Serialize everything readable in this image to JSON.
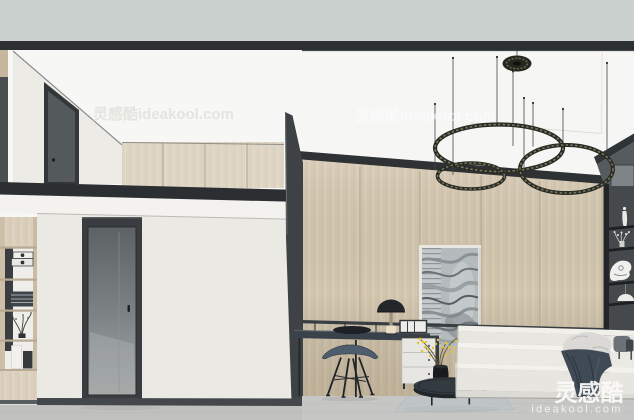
{
  "watermarks": {
    "tile": "灵感酷ideakool.com",
    "brand_name": "灵感酷",
    "brand_domain": "ideakool.com"
  },
  "palette": {
    "ceiling_band": "#cbd1ce",
    "beam_dark": "#2c3032",
    "wall_white": "#f6f6f4",
    "plaster": "#eae9e4",
    "wood_light": "#d4c7b0",
    "wood_seam": "#b4a68e",
    "trim_dark": "#2e3234",
    "floor_gray": "#c6c7c5",
    "chair_blue": "#4d5d6d",
    "plant_yellow": "#e3c22e",
    "blanket_slate": "#3f4a54",
    "stone_gray": "#b5bbbd",
    "shelf_dark": "#45494c"
  },
  "objects": [
    "ring-pendant-chandelier",
    "loft-door",
    "glass-door",
    "bookshelf",
    "loft-wardrobe",
    "wall-desk",
    "mushroom-desk-lamp",
    "desk-chair",
    "drawer-cabinet",
    "stone-art-panel",
    "coffee-table",
    "yellow-plant",
    "platform-sofa",
    "display-shelf"
  ]
}
